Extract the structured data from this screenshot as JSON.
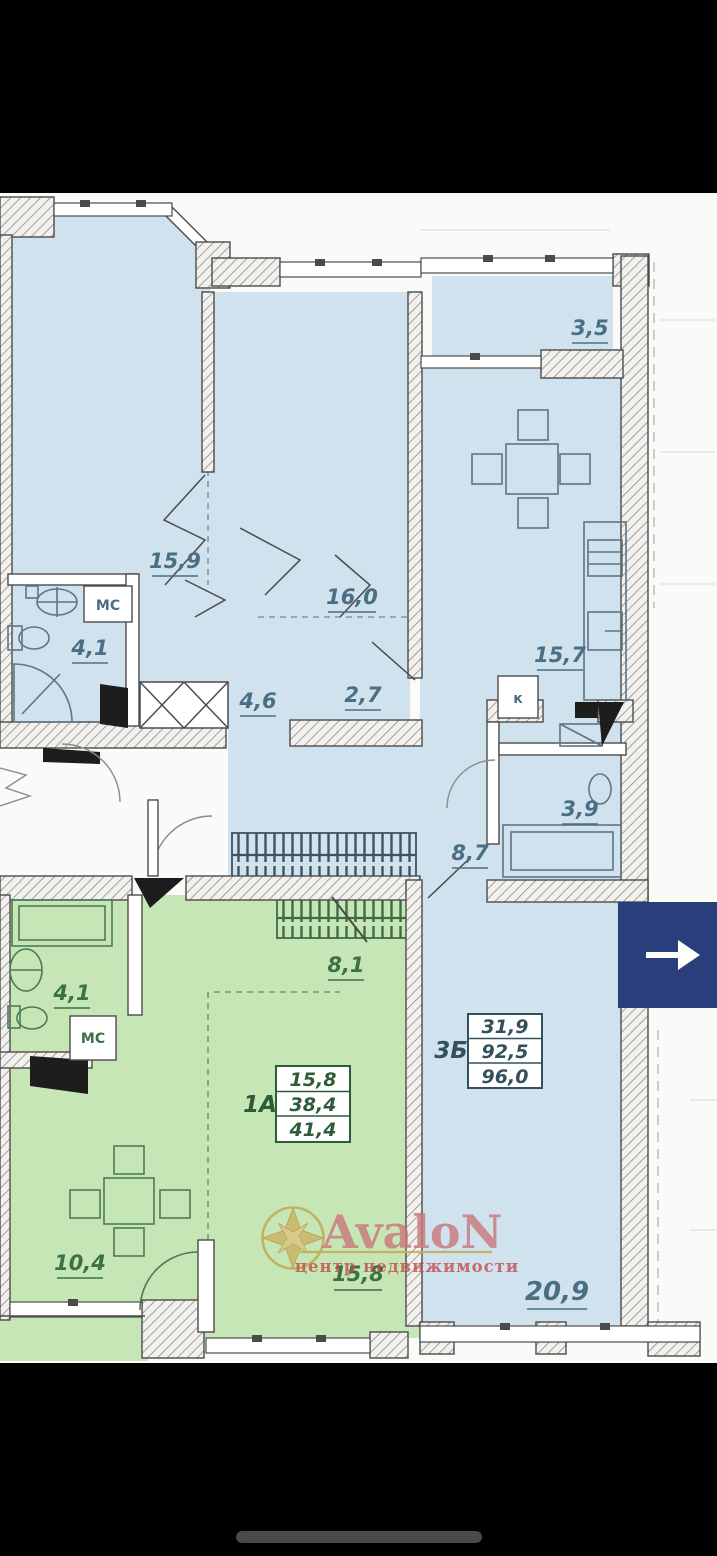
{
  "watermark": {
    "brand": "AvaloN",
    "tagline": "центр недвижимости",
    "brand_color": "#c9787b",
    "compass_gold": "#c2ae5c"
  },
  "nav": {
    "next_arrow_icon": "arrow-right",
    "button_color": "#2b3e7c"
  },
  "colors": {
    "apartment_3b_fill": "#cfe2ee",
    "apartment_1a_fill": "#c6e7b5",
    "wall_outline": "#4b4b4b",
    "label_blue": "#4a6e84",
    "label_green": "#3c7046"
  },
  "apartment_3b": {
    "id": "3Б",
    "stats": {
      "living_area": "31,9",
      "heated_area": "92,5",
      "total_area": "96,0"
    },
    "rooms": {
      "bedroom1": "15,9",
      "bedroom2": "16,0",
      "kitchen": "15,7",
      "bathroom": "4,1",
      "corridor1": "4,6",
      "corridor2": "2,7",
      "hall": "8,7",
      "wc": "3,9",
      "living_room": "20,9",
      "balcony": "3,5"
    },
    "marks": {
      "storage": "МС",
      "kitchen_mark": "к"
    }
  },
  "apartment_1a": {
    "id": "1А",
    "stats": {
      "living_area": "15,8",
      "heated_area": "38,4",
      "total_area": "41,4"
    },
    "rooms": {
      "bathroom": "4,1",
      "loggia": "8,1",
      "kitchen": "10,4",
      "living_room": "15,8"
    },
    "marks": {
      "storage": "МС"
    }
  }
}
